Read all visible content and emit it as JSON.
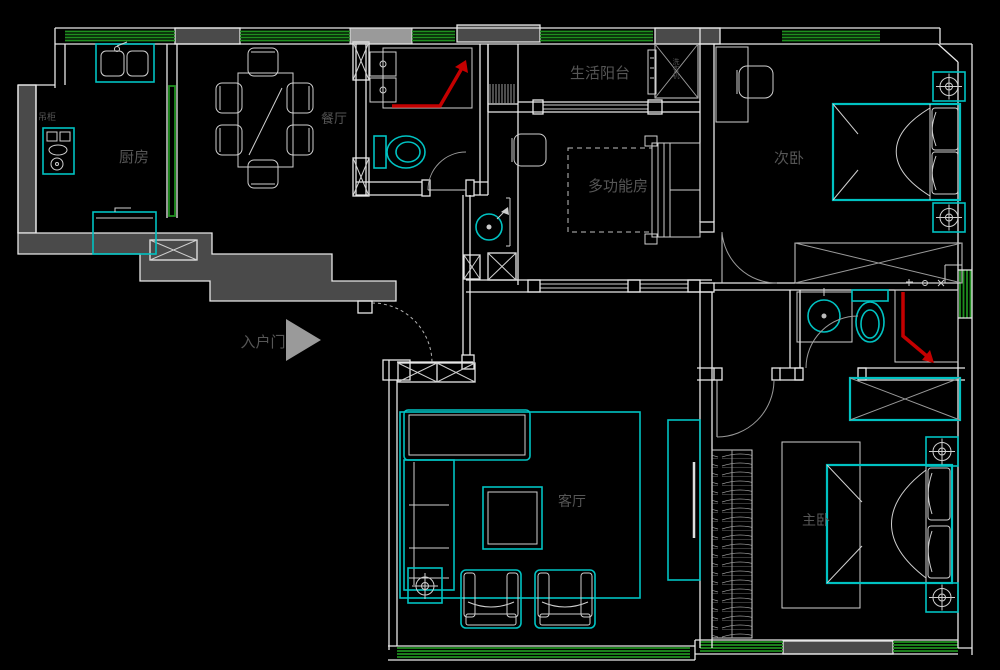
{
  "drawing": {
    "type": "apartment-floor-plan",
    "background": "#000000",
    "colors": {
      "wall_line": "#e8e8e8",
      "wall_fill": "#4a4a4a",
      "furniture_line": "#cfcfcf",
      "cyan_furniture": "#00c2c2",
      "window_green": "#1f8f1f",
      "shower_red": "#c40000",
      "label_text": "#565656",
      "entry_arrow": "#9a9a9a"
    },
    "rooms": {
      "kitchen": {
        "label": "厨房"
      },
      "dining": {
        "label": "餐厅"
      },
      "service_balcony": {
        "label": "生活阳台"
      },
      "multi_function": {
        "label": "多功能房"
      },
      "bedroom2": {
        "label": "次卧"
      },
      "living": {
        "label": "客厅"
      },
      "master_bedroom": {
        "label": "主卧"
      }
    },
    "annotations": {
      "entry": {
        "label": "入户门"
      },
      "hanging_cabinet": {
        "label": "吊柜"
      },
      "washer": {
        "label": "洗衣机"
      }
    }
  }
}
